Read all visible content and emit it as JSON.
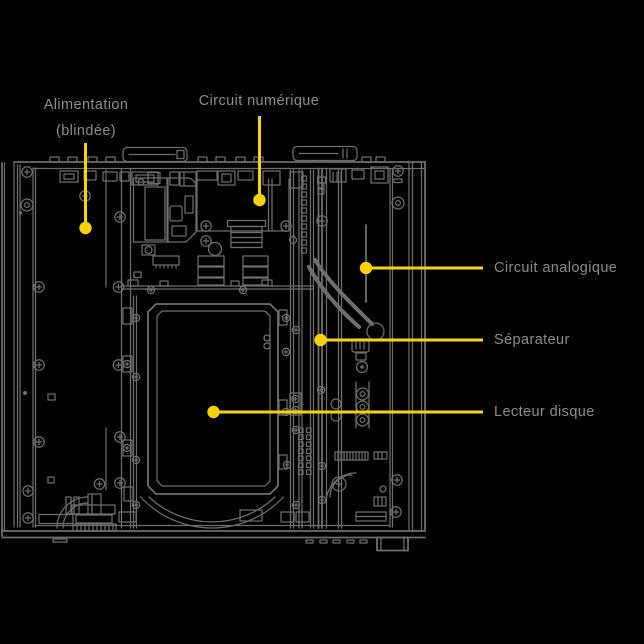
{
  "colors": {
    "background": "#000000",
    "callout": "#f8d30b",
    "label_text": "#8c8c8c",
    "wireframe": "#6e6e6e"
  },
  "callouts": {
    "power": {
      "label_line1": "Alimentation",
      "label_line2": "(blindée)"
    },
    "digital": {
      "label": "Circuit numérique"
    },
    "analog": {
      "label": "Circuit analogique"
    },
    "separator": {
      "label": "Séparateur"
    },
    "disc": {
      "label": "Lecteur disque"
    }
  }
}
